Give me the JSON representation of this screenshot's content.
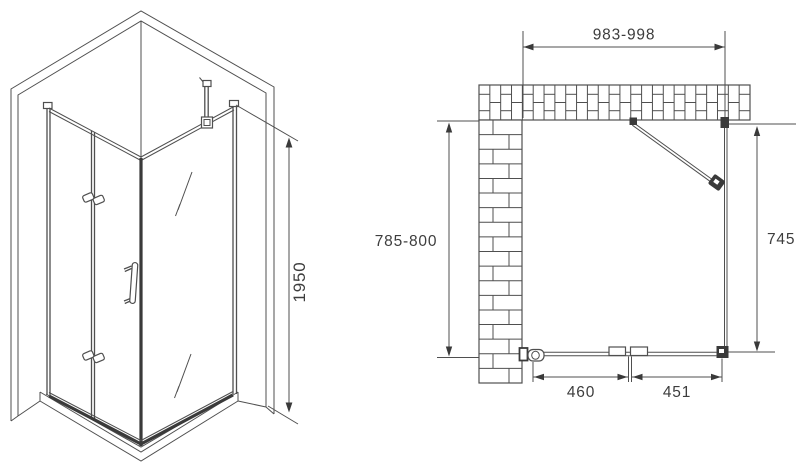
{
  "colors": {
    "line": "#4f4f4f",
    "dark": "#3a3a3a",
    "text": "#3d3d3d",
    "background": "#ffffff"
  },
  "isometric_view": {
    "height_dim": "1950"
  },
  "plan_view": {
    "top_width_dim": "983-998",
    "left_depth_dim": "785-800",
    "right_side_dim": "745",
    "door_panel_dim": "460",
    "fixed_panel_dim": "451"
  }
}
